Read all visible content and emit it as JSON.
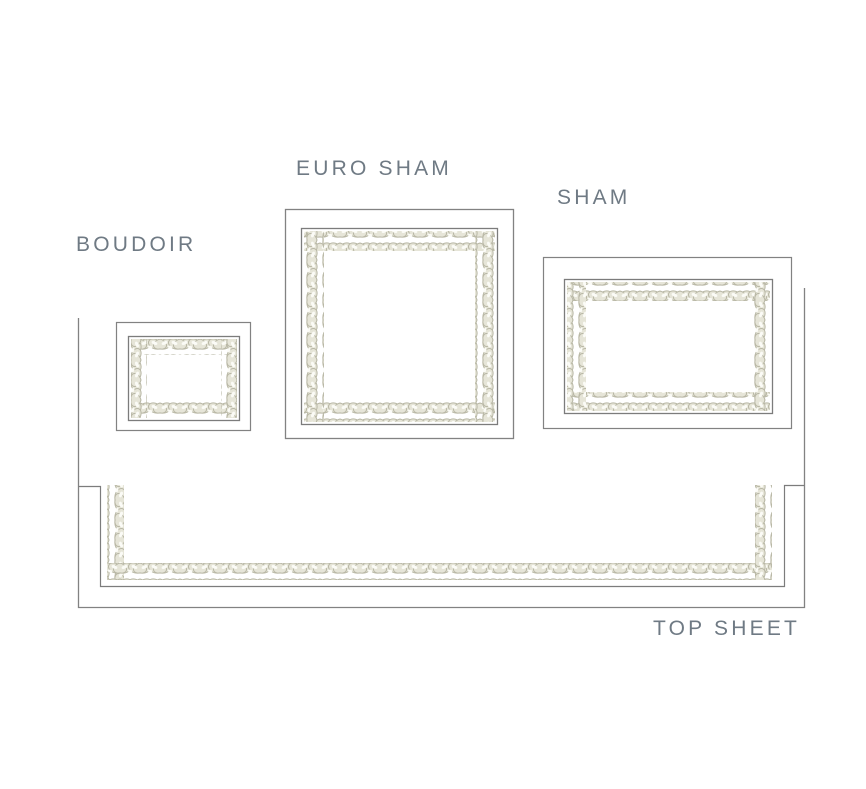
{
  "diagram": {
    "title": "Bedding embroidery placement diagram",
    "items": [
      {
        "id": "boudoir",
        "label": "BOUDOIR"
      },
      {
        "id": "euro_sham",
        "label": "EURO SHAM"
      },
      {
        "id": "sham",
        "label": "SHAM"
      },
      {
        "id": "top_sheet",
        "label": "TOP SHEET"
      }
    ],
    "colors": {
      "background": "#ffffff",
      "label_text": "#6f7a84",
      "outline": "#828282",
      "braid_base": "#e6e5d8",
      "braid_shadow": "#b9b8a6",
      "braid_highlight": "#fbfbf6"
    }
  }
}
